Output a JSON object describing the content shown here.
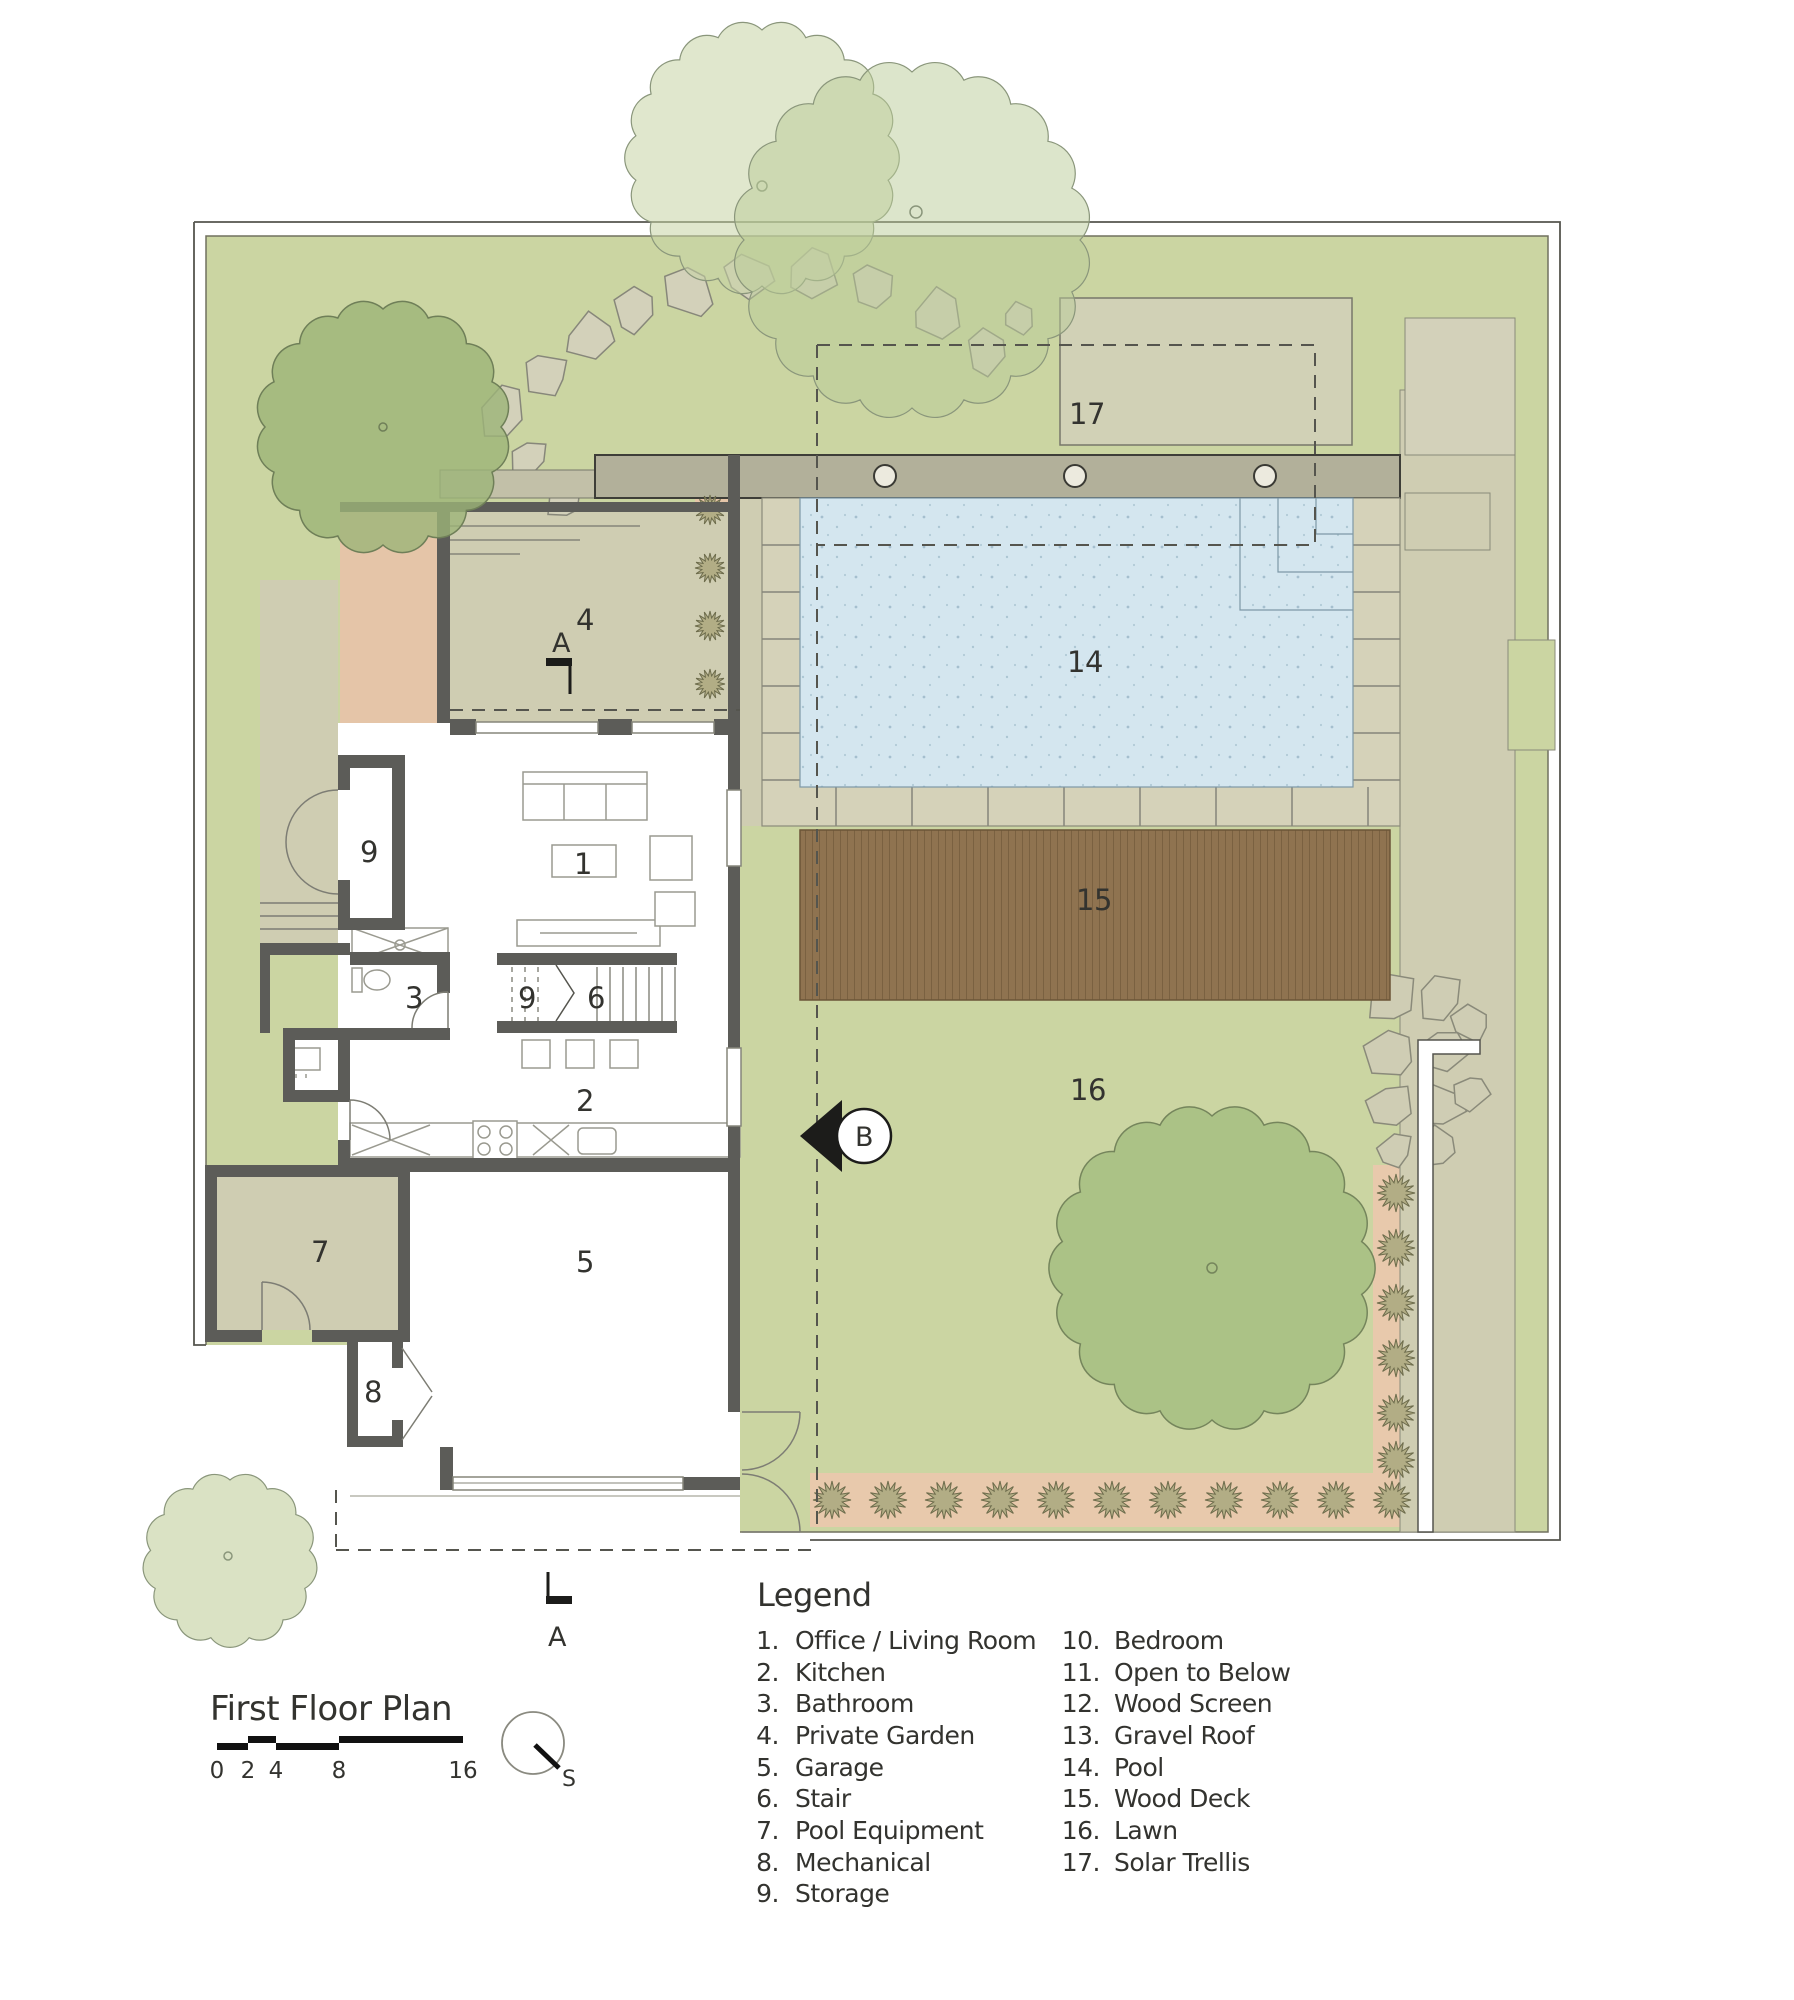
{
  "title_block": {
    "title": "First Floor Plan",
    "scale_ticks": [
      "0",
      "2",
      "4",
      "8",
      "16"
    ],
    "compass_label": "S"
  },
  "legend": {
    "heading": "Legend",
    "column1": [
      {
        "num": "1.",
        "label": "Office / Living Room"
      },
      {
        "num": "2.",
        "label": "Kitchen"
      },
      {
        "num": "3.",
        "label": "Bathroom"
      },
      {
        "num": "4.",
        "label": "Private Garden"
      },
      {
        "num": "5.",
        "label": "Garage"
      },
      {
        "num": "6.",
        "label": "Stair"
      },
      {
        "num": "7.",
        "label": "Pool Equipment"
      },
      {
        "num": "8.",
        "label": "Mechanical"
      },
      {
        "num": "9.",
        "label": "Storage"
      }
    ],
    "column2": [
      {
        "num": "10.",
        "label": "Bedroom"
      },
      {
        "num": "11.",
        "label": "Open to Below"
      },
      {
        "num": "12.",
        "label": "Wood Screen"
      },
      {
        "num": "13.",
        "label": "Gravel Roof"
      },
      {
        "num": "14.",
        "label": "Pool"
      },
      {
        "num": "15.",
        "label": "Wood Deck"
      },
      {
        "num": "16.",
        "label": "Lawn"
      },
      {
        "num": "17.",
        "label": "Solar Trellis"
      }
    ]
  },
  "plan_labels": {
    "n1": "1",
    "n2": "2",
    "n3": "3",
    "n4": "4",
    "n5": "5",
    "n6": "6",
    "n7": "7",
    "n8": "8",
    "n9a": "9",
    "n9b": "9",
    "n14": "14",
    "n15": "15",
    "n16": "16",
    "n17": "17"
  },
  "section_markers": {
    "a_top": "A",
    "a_bottom": "A",
    "b": "B"
  },
  "colors": {
    "site_green": "#cbd5a2",
    "paving_olive": "#cfcdb2",
    "stone_beige": "#d3d1ba",
    "roof_gray": "#b2b09a",
    "peach": "#e5c5a8",
    "pool_blue": "#d4e6ef",
    "deck_brown": "#8f7350",
    "wall_dark": "#5c5c58",
    "tree_green": "#a8c083",
    "canopy_light": "#c6d3a4",
    "text": "#33332f"
  }
}
